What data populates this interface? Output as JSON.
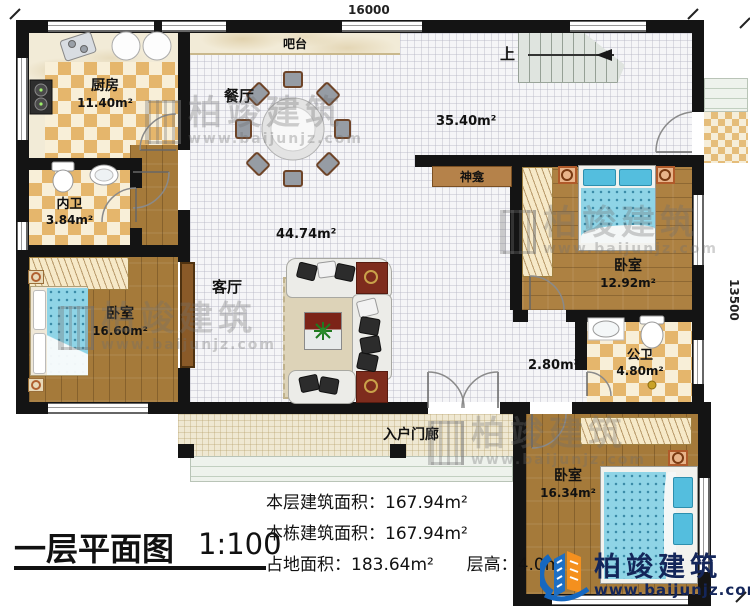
{
  "plan": {
    "dim_top": "16000",
    "dim_right": "13500",
    "stairs_up": "上",
    "rooms": {
      "kitchen": {
        "name": "厨房",
        "area": "11.40m²"
      },
      "bar": {
        "name": "吧台"
      },
      "dining": {
        "name": "餐厅"
      },
      "inner_bath": {
        "name": "内卫",
        "area": "3.84m²"
      },
      "bedroom_left": {
        "name": "卧室",
        "area": "16.60m²"
      },
      "living": {
        "name": "客厅",
        "area": "44.74m²"
      },
      "hall_area": "35.40m²",
      "shrine": {
        "name": "神龛"
      },
      "bedroom_right": {
        "name": "卧室",
        "area": "12.92m²"
      },
      "public_bath": {
        "name": "公卫",
        "area": "4.80m²"
      },
      "pass_area": "2.80m²",
      "bedroom_bottom": {
        "name": "卧室",
        "area": "16.34m²"
      },
      "porch": {
        "name": "入户门廊"
      }
    }
  },
  "footer": {
    "stats": [
      {
        "label": "本层建筑面积：",
        "value": "167.94m²"
      },
      {
        "label": "本栋建筑面积：",
        "value": "167.94m²"
      },
      {
        "label": "占地面积：",
        "value": "183.64m²"
      },
      {
        "label": "层高：",
        "value": "4.0m"
      }
    ],
    "title": "一层平面图",
    "scale": "1:100"
  },
  "branding": {
    "watermark": {
      "name": "柏竣建筑",
      "url": "www.baijunjz.com"
    },
    "logo": {
      "name": "柏竣建筑",
      "url": "www.baijunjz.com"
    },
    "colors": {
      "logo_navy": "#14265a",
      "logo_blue": "#1668c0",
      "logo_orange": "#f4901e",
      "wall": "#141414",
      "bed_blue": "#8fd4e6",
      "wood": "#a57a3a",
      "tile_tan": "#e5b66c"
    }
  }
}
